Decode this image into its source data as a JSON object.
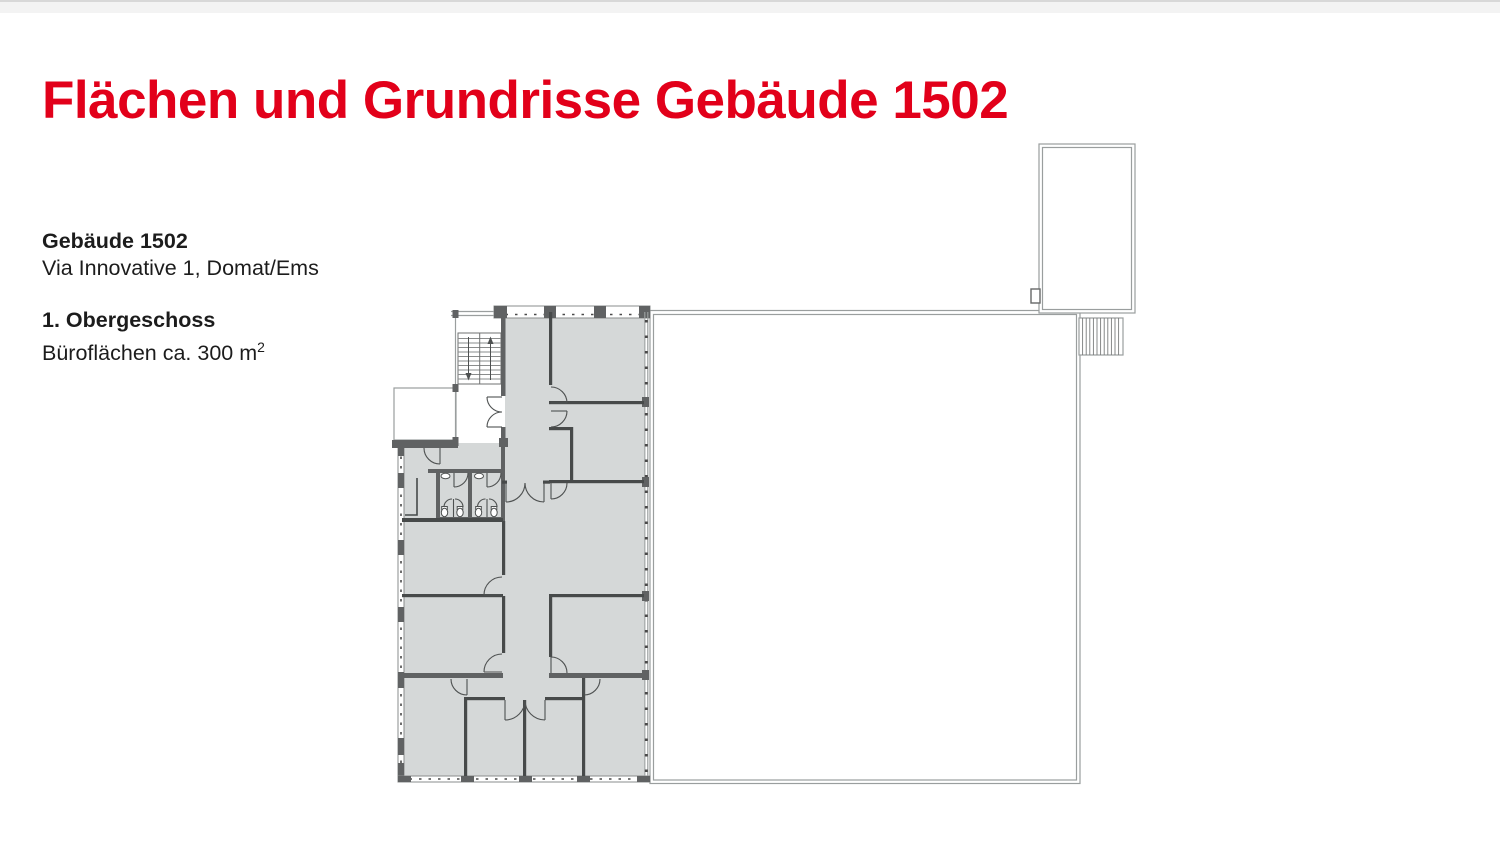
{
  "theme": {
    "accent": "#e2001a",
    "text": "#1c1c1c",
    "room": "#d5d8d8",
    "wall": "#606263",
    "iwall": "#474a4a",
    "outline": "#9a9e9e",
    "dash": "#4a4a4a"
  },
  "header": {
    "title": "Flächen und Grundrisse Gebäude 1502"
  },
  "info": {
    "building_name": "Gebäude 1502",
    "address": "Via Innovative 1, Domat/Ems",
    "floor": "1. Obergeschoss",
    "area_label": "Büroflächen ca. 300 m",
    "area_superscript": "2"
  }
}
